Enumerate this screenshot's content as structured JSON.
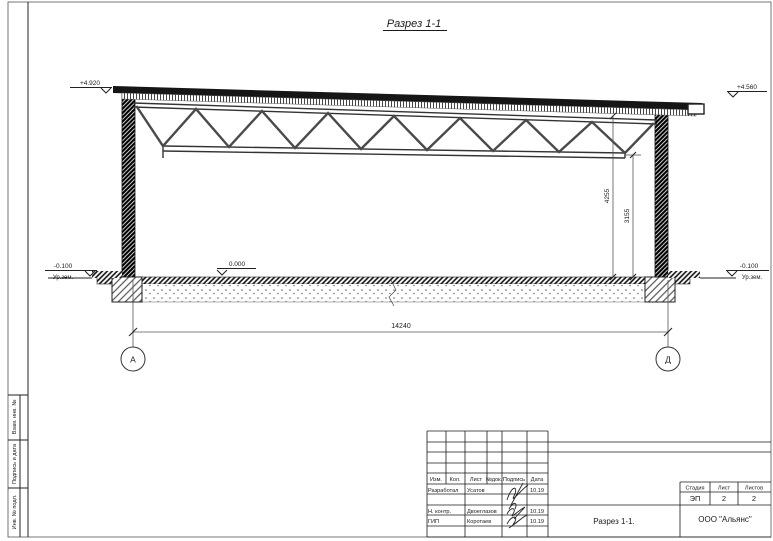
{
  "drawing": {
    "title": "Разрез 1-1",
    "elevations": {
      "ridge_left": "+4.920",
      "ridge_right": "+4.560",
      "floor": "0.000",
      "ground_left": "-0.100",
      "ground_right": "-0.100",
      "ground_text": "Ур.зем."
    },
    "dims": {
      "span": "14240",
      "h_roof": "4255",
      "h_truss": "3155"
    },
    "axes": {
      "left": "А",
      "right": "Д"
    }
  },
  "margin_strip": {
    "cells": [
      "Взам. инв. №",
      "Подпись и дата",
      "Инв. № подл."
    ]
  },
  "title_block": {
    "header": [
      "Изм.",
      "Кол.",
      "Лист",
      "№док.",
      "Подпись",
      "Дата"
    ],
    "rows": [
      {
        "role": "Разработал",
        "name": "Усатов",
        "date": "10.19"
      },
      {
        "role": "Н. контр.",
        "name": "Двоеглазов",
        "date": "10.19"
      },
      {
        "role": "ГИП",
        "name": "Коротаев",
        "date": "10.19"
      }
    ],
    "stage": {
      "label": "Стадия",
      "value": "ЭП"
    },
    "sheet": {
      "label": "Лист",
      "value": "2"
    },
    "sheets": {
      "label": "Листов",
      "value": "2"
    },
    "doc_title": "Разрез 1-1.",
    "company": "ООО \"Альянс\""
  }
}
